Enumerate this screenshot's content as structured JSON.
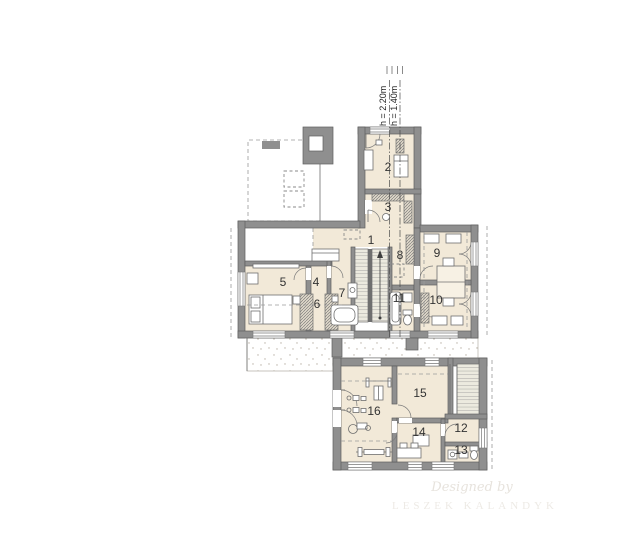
{
  "plan": {
    "type": "attic-floor-plan",
    "rooms": [
      {
        "number": "1"
      },
      {
        "number": "2"
      },
      {
        "number": "3"
      },
      {
        "number": "4"
      },
      {
        "number": "5"
      },
      {
        "number": "6"
      },
      {
        "number": "7"
      },
      {
        "number": "8"
      },
      {
        "number": "9"
      },
      {
        "number": "10"
      },
      {
        "number": "11"
      },
      {
        "number": "12"
      },
      {
        "number": "13"
      },
      {
        "number": "14"
      },
      {
        "number": "15"
      },
      {
        "number": "16"
      }
    ],
    "height_annotations": [
      {
        "text": "h = 2.20m"
      },
      {
        "text": "h = 1.40m"
      }
    ],
    "watermark": {
      "line1": "Designed by",
      "line2": "LESZEK KALANDYK"
    },
    "colors": {
      "wall": "#8f8f8f",
      "floor": "#f2e9d8",
      "paper": "#ffffff",
      "dashed_line": "#9a9a9a",
      "stipple": "#b9b2a6",
      "watermark": "#e9e6e1"
    }
  }
}
